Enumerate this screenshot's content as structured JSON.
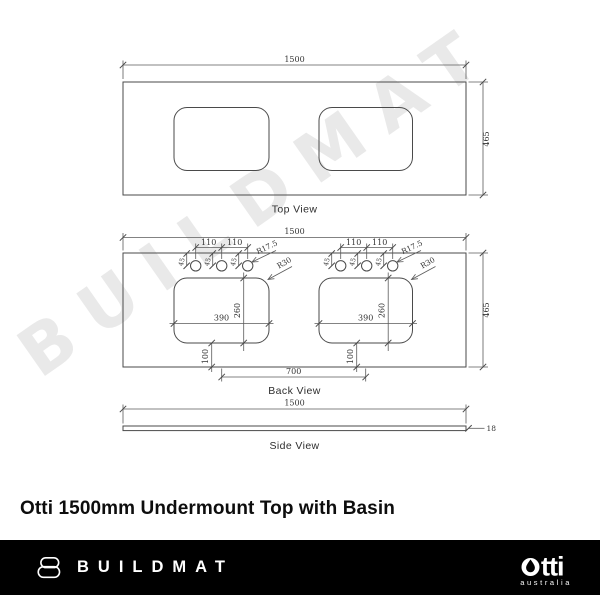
{
  "watermark": "BUILDMAT",
  "title": "Otti 1500mm Undermount Top with Basin",
  "views": {
    "top": {
      "label": "Top View",
      "width": "1500",
      "depth": "465"
    },
    "back": {
      "label": "Back View",
      "width": "1500",
      "depth": "465",
      "hole_pitch": "110",
      "hole_setback": "45",
      "hole_radius": "R17.5",
      "corner_radius": "R30",
      "cutout_width": "390",
      "cutout_height": "260",
      "front_offset": "100",
      "basin_centres": "700"
    },
    "side": {
      "label": "Side View",
      "width": "1500",
      "thickness": "18"
    }
  },
  "footer": {
    "brand": "BUILDMAT",
    "otti_wordmark": "otti",
    "otti_suffix": "tti",
    "otti_sub": "australia"
  },
  "colors": {
    "line": "#4a4a4a",
    "dim_text": "#333333",
    "footer_bar": "#000000",
    "watermark": "#e9e9e9"
  }
}
